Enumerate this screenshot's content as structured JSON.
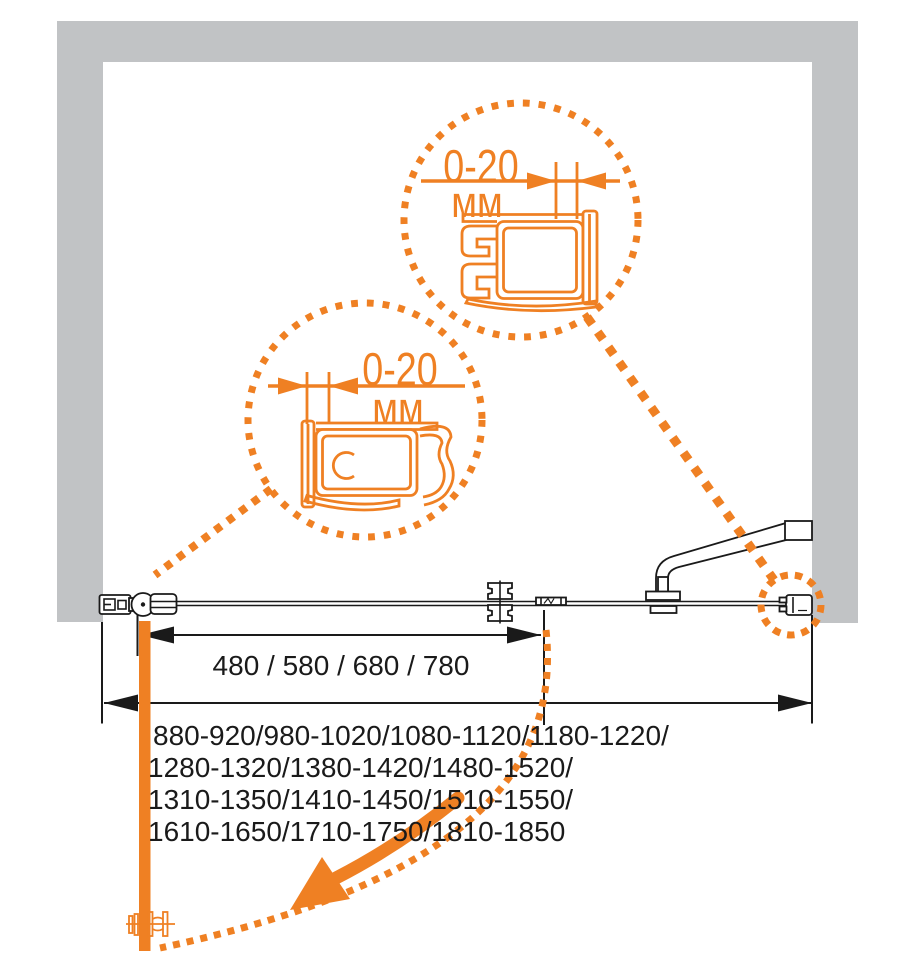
{
  "colors": {
    "accent_orange": "#EF8023",
    "wall_gray": "#C1C3C5",
    "line_black": "#1A1A1A",
    "background": "#FFFFFF"
  },
  "callouts": {
    "top": {
      "value": "0-20",
      "unit": "мм"
    },
    "left": {
      "value": "0-20",
      "unit": "мм"
    }
  },
  "dimensions": {
    "door_widths": "480 / 580 / 680 / 780",
    "range_lines": [
      "880-920/980-1020/1080-1120/1180-1220/",
      "1280-1320/1380-1420/1480-1520/",
      "1310-1350/1410-1450/1510-1550/",
      "1610-1650/1710-1750/1810-1850"
    ]
  }
}
